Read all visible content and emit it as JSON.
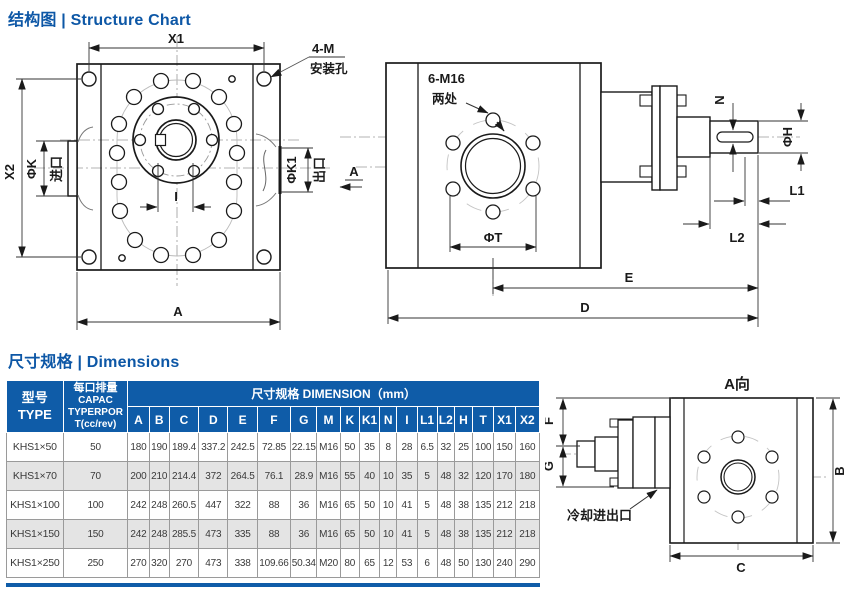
{
  "sections": {
    "structure_title": "结构图 | Structure Chart",
    "dimensions_title": "尺寸规格 | Dimensions"
  },
  "drawings": {
    "front": {
      "x1": "X1",
      "x2": "X2",
      "a": "A",
      "i": "I",
      "phi_k": "ΦK",
      "inlet": "进口",
      "phi_k1": "ΦK1",
      "outlet": "出口",
      "mount_count": "4-M",
      "mount_hole": "安装孔",
      "section_a": "A"
    },
    "side": {
      "bolt_note": "6-M16",
      "bolt_places": "两处",
      "phi_t": "ΦT",
      "n": "N",
      "phi_h": "ΦH",
      "l1": "L1",
      "l2": "L2",
      "e": "E",
      "d": "D"
    },
    "view_a": {
      "title": "A向",
      "f": "F",
      "g": "G",
      "b": "B",
      "c": "C",
      "cooling": "冷却进出口"
    }
  },
  "table": {
    "header": {
      "type_zh": "型号",
      "type_en": "TYPE",
      "capacity_lines": [
        "每口排量",
        "CAPAC",
        "TYPERPOR",
        "T(cc/rev)"
      ],
      "dimension_title": "尺寸规格 DIMENSION（mm）",
      "columns": [
        "A",
        "B",
        "C",
        "D",
        "E",
        "F",
        "G",
        "M",
        "K",
        "K1",
        "N",
        "I",
        "L1",
        "L2",
        "H",
        "T",
        "X1",
        "X2"
      ]
    },
    "rows": [
      {
        "type": "KHS1×50",
        "capacity": "50",
        "values": [
          "180",
          "190",
          "189.4",
          "337.2",
          "242.5",
          "72.85",
          "22.15",
          "M16",
          "50",
          "35",
          "8",
          "28",
          "6.5",
          "32",
          "25",
          "100",
          "150",
          "160"
        ]
      },
      {
        "type": "KHS1×70",
        "capacity": "70",
        "values": [
          "200",
          "210",
          "214.4",
          "372",
          "264.5",
          "76.1",
          "28.9",
          "M16",
          "55",
          "40",
          "10",
          "35",
          "5",
          "48",
          "32",
          "120",
          "170",
          "180"
        ]
      },
      {
        "type": "KHS1×100",
        "capacity": "100",
        "values": [
          "242",
          "248",
          "260.5",
          "447",
          "322",
          "88",
          "36",
          "M16",
          "65",
          "50",
          "10",
          "41",
          "5",
          "48",
          "38",
          "135",
          "212",
          "218"
        ]
      },
      {
        "type": "KHS1×150",
        "capacity": "150",
        "values": [
          "242",
          "248",
          "285.5",
          "473",
          "335",
          "88",
          "36",
          "M16",
          "65",
          "50",
          "10",
          "41",
          "5",
          "48",
          "38",
          "135",
          "212",
          "218"
        ]
      },
      {
        "type": "KHS1×250",
        "capacity": "250",
        "values": [
          "270",
          "320",
          "270",
          "473",
          "338",
          "109.66",
          "50.34",
          "M20",
          "80",
          "65",
          "12",
          "53",
          "6",
          "48",
          "50",
          "130",
          "240",
          "290"
        ]
      }
    ]
  }
}
